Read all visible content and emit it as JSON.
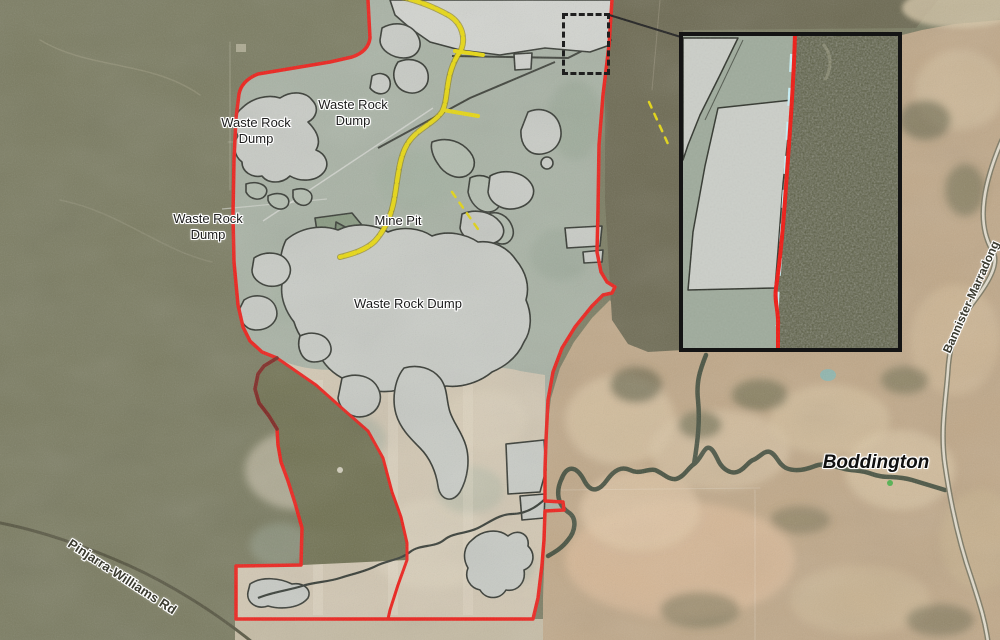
{
  "map": {
    "labels": {
      "wrd_top": {
        "line1": "Waste Rock",
        "line2": "Dump"
      },
      "wrd_west_upper": {
        "line1": "Waste Rock",
        "line2": "Dump"
      },
      "wrd_west_lower": {
        "line1": "Waste Rock",
        "line2": "Dump"
      },
      "mine_pit": "Mine Pit",
      "wrd_central": "Waste Rock Dump",
      "town": "Boddington",
      "road_southwest": "Pinjarra-Williams Rd",
      "road_east": "Bannister-Marradong"
    },
    "colors": {
      "boundary_red": "#ee1c16",
      "boundary_dark_red": "#7a241f",
      "haul_route_yellow": "#e9d90e",
      "disturbance_gray": "#c8cbc5",
      "inset_dash_cyan": "#c6eef5",
      "bushland_olive": "#7a7b60",
      "farmland_tan": "#c0a888"
    }
  }
}
